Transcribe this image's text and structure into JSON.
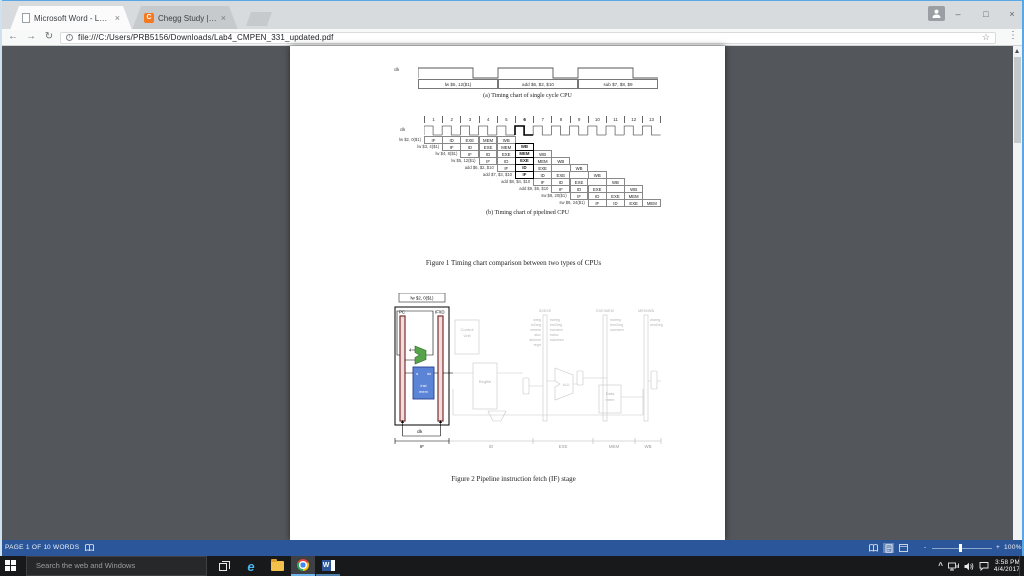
{
  "window": {
    "tabs": [
      {
        "title": "Microsoft Word - Lab4_C",
        "close": "×"
      },
      {
        "title": "Chegg Study | Guided S",
        "close": "×",
        "favicon_letter": "C"
      }
    ],
    "controls": {
      "minimize": "–",
      "maximize": "□",
      "close": "×"
    }
  },
  "toolbar": {
    "back": "←",
    "forward": "→",
    "reload": "↻",
    "info": "i",
    "url": "file:///C:/Users/PRB5156/Downloads/Lab4_CMPEN_331_updated.pdf",
    "bookmark_star": "☆",
    "menu": "⋮"
  },
  "pdf": {
    "figure1_caption": "Figure 1 Timing chart comparison between two types of CPUs",
    "figure2": {
      "caption": "Figure 2 Pipeline instruction fetch (IF) stage",
      "instruction_box": "lw $2, 0($1)",
      "pc": "PC",
      "ifid": "IF/ID",
      "group_headers": [
        "ID/EXE",
        "EXE/MEM",
        "MEM/WB"
      ],
      "control_unit": [
        "Control",
        "Unit"
      ],
      "signals_id": [
        "wreg",
        "m2reg",
        "wmem",
        "aluc",
        "aluimm",
        "regrt"
      ],
      "signals_exe": [
        "ewreg",
        "em2reg",
        "ewmem",
        "ealuc",
        "ealuimm"
      ],
      "signals_mem": [
        "mwreg",
        "mm2reg",
        "mwmem"
      ],
      "signals_wb": [
        "wwreg",
        "wm2reg"
      ],
      "adder_const": "4",
      "inst_mem": [
        "inst",
        "mem"
      ],
      "port_a": "a",
      "port_do": "do",
      "regfile": "Regfile",
      "alu": "ALU",
      "data_mem": [
        "Data",
        "mem"
      ],
      "clk": "clk",
      "stage_labels": [
        "IF",
        "ID",
        "EXE",
        "MEM",
        "WB"
      ]
    }
  },
  "chart_data": [
    {
      "type": "timing",
      "title": "(a) Timing chart of single cycle CPU",
      "clk_label": "clk",
      "cycles": 3,
      "instructions": [
        "lw $5, 12($1)",
        "add $6, $2, $10",
        "sub $7, $8, $9"
      ]
    },
    {
      "type": "timing",
      "title": "(b) Timing chart of pipelined CPU",
      "clk_label": "clk",
      "cycles": 13,
      "highlight_cycle": 6,
      "stages": [
        "IF",
        "ID",
        "EXE",
        "MEM",
        "WB"
      ],
      "rows": [
        {
          "label": "lw $2, 0($1)",
          "start": 1,
          "stages": [
            "IF",
            "ID",
            "EXE",
            "MEM",
            "WB"
          ]
        },
        {
          "label": "lw $3, 4($1)",
          "start": 2,
          "stages": [
            "IF",
            "ID",
            "EXE",
            "MEM",
            "WB"
          ]
        },
        {
          "label": "lw $4, 8($1)",
          "start": 3,
          "stages": [
            "IF",
            "ID",
            "EXE",
            "MEM",
            "WB"
          ]
        },
        {
          "label": "lw $5, 12($1)",
          "start": 4,
          "stages": [
            "IF",
            "ID",
            "EXE",
            "MEM",
            "WB"
          ]
        },
        {
          "label": "add $6, $2, $10",
          "start": 5,
          "stages": [
            "IF",
            "ID",
            "EXE",
            "",
            "WB"
          ]
        },
        {
          "label": "add $7, $3, $10",
          "start": 6,
          "stages": [
            "IF",
            "ID",
            "EXE",
            "",
            "WB"
          ]
        },
        {
          "label": "add $8, $4, $10",
          "start": 7,
          "stages": [
            "IF",
            "ID",
            "EXE",
            "",
            "WB"
          ]
        },
        {
          "label": "add $9, $5, $10",
          "start": 8,
          "stages": [
            "IF",
            "ID",
            "EXE",
            "",
            "WB"
          ]
        },
        {
          "label": "sw $8, 20($1)",
          "start": 9,
          "stages": [
            "IF",
            "ID",
            "EXE",
            "MEM"
          ]
        },
        {
          "label": "sw $9, 24($1)",
          "start": 10,
          "stages": [
            "IF",
            "ID",
            "EXE",
            "MEM"
          ]
        }
      ]
    }
  ],
  "word_statusbar": {
    "page_count": "PAGE 1 OF 1",
    "word_count": "0 WORDS",
    "zoom_out": "-",
    "zoom_in": "+",
    "zoom_level": "100%"
  },
  "taskbar": {
    "search_placeholder": "Search the web and Windows",
    "edge_letter": "e",
    "word_letter": "W",
    "tray_chevron": "^",
    "time": "3:58 PM",
    "date": "4/4/2017"
  },
  "colors": {
    "accent_blue": "#2b579a",
    "viewer_gray": "#53565a",
    "chegg_orange": "#f47920"
  }
}
